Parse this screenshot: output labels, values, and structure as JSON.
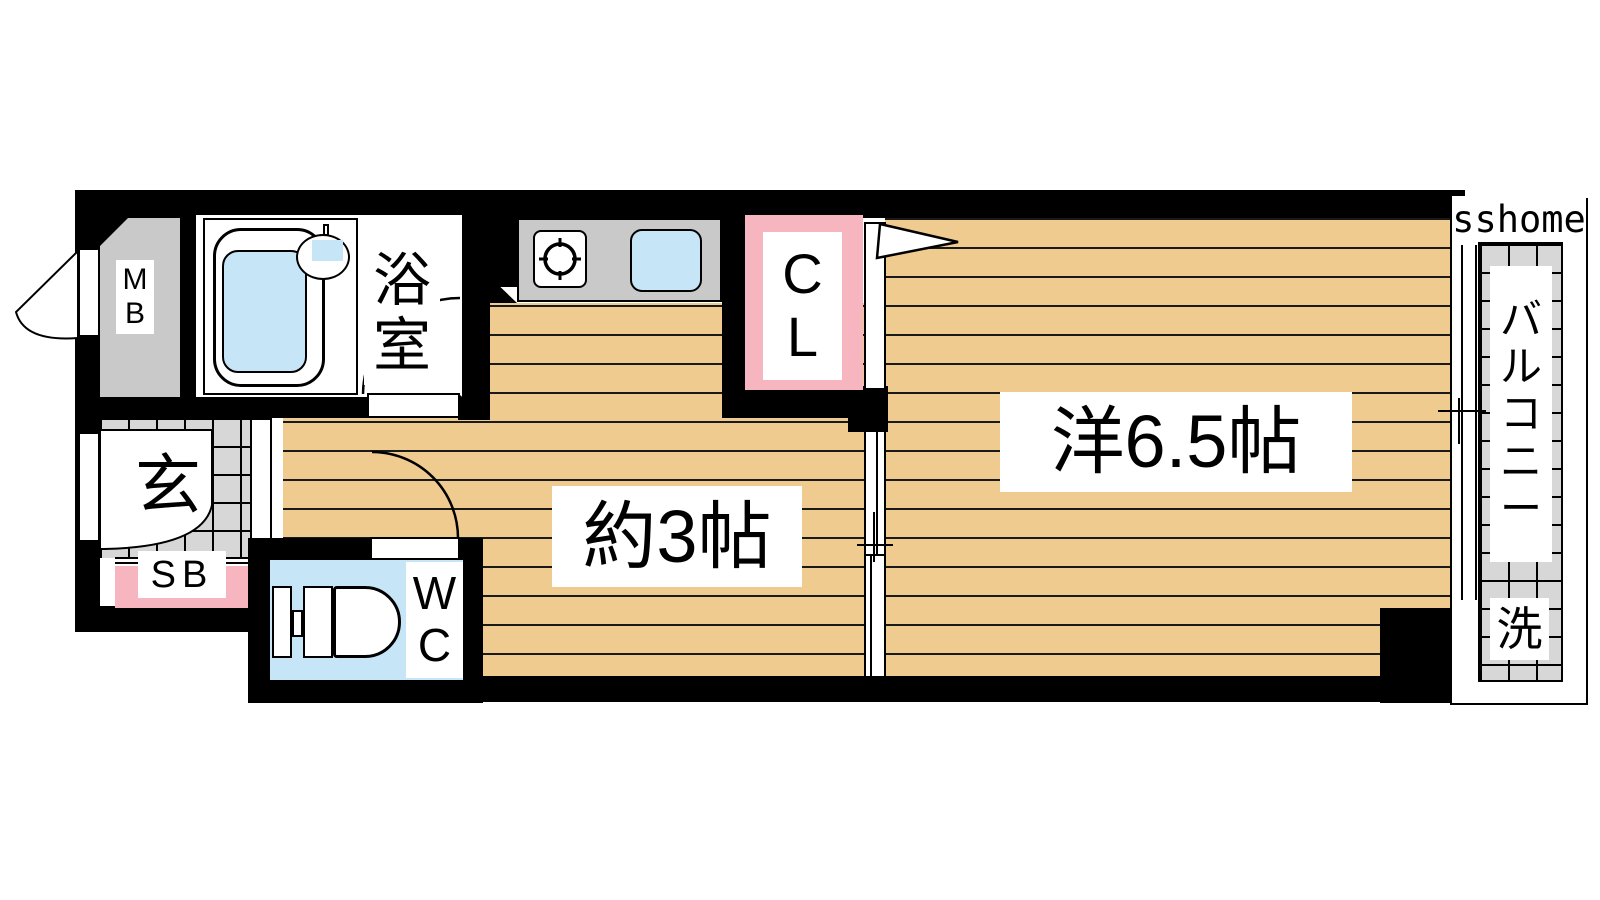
{
  "watermark": "sshome",
  "labels": {
    "meter_box": "MB",
    "bathroom": "浴室",
    "closet": "CL",
    "entrance": "玄",
    "shoe_box": "SB",
    "toilet": "WC",
    "hallway_kitchen": "約3帖",
    "western_room": "洋6.5帖",
    "balcony": "バルコニー",
    "laundry": "洗"
  },
  "colors": {
    "wall": "#000000",
    "wood_floor": "#f0cb90",
    "tile_gray": "#d7d7d7",
    "counter_gray": "#c9c9c9",
    "accent_pink": "#f7b6bf",
    "water_blue": "#c6e6f7",
    "label_bg": "#ffffff",
    "text": "#000000"
  }
}
